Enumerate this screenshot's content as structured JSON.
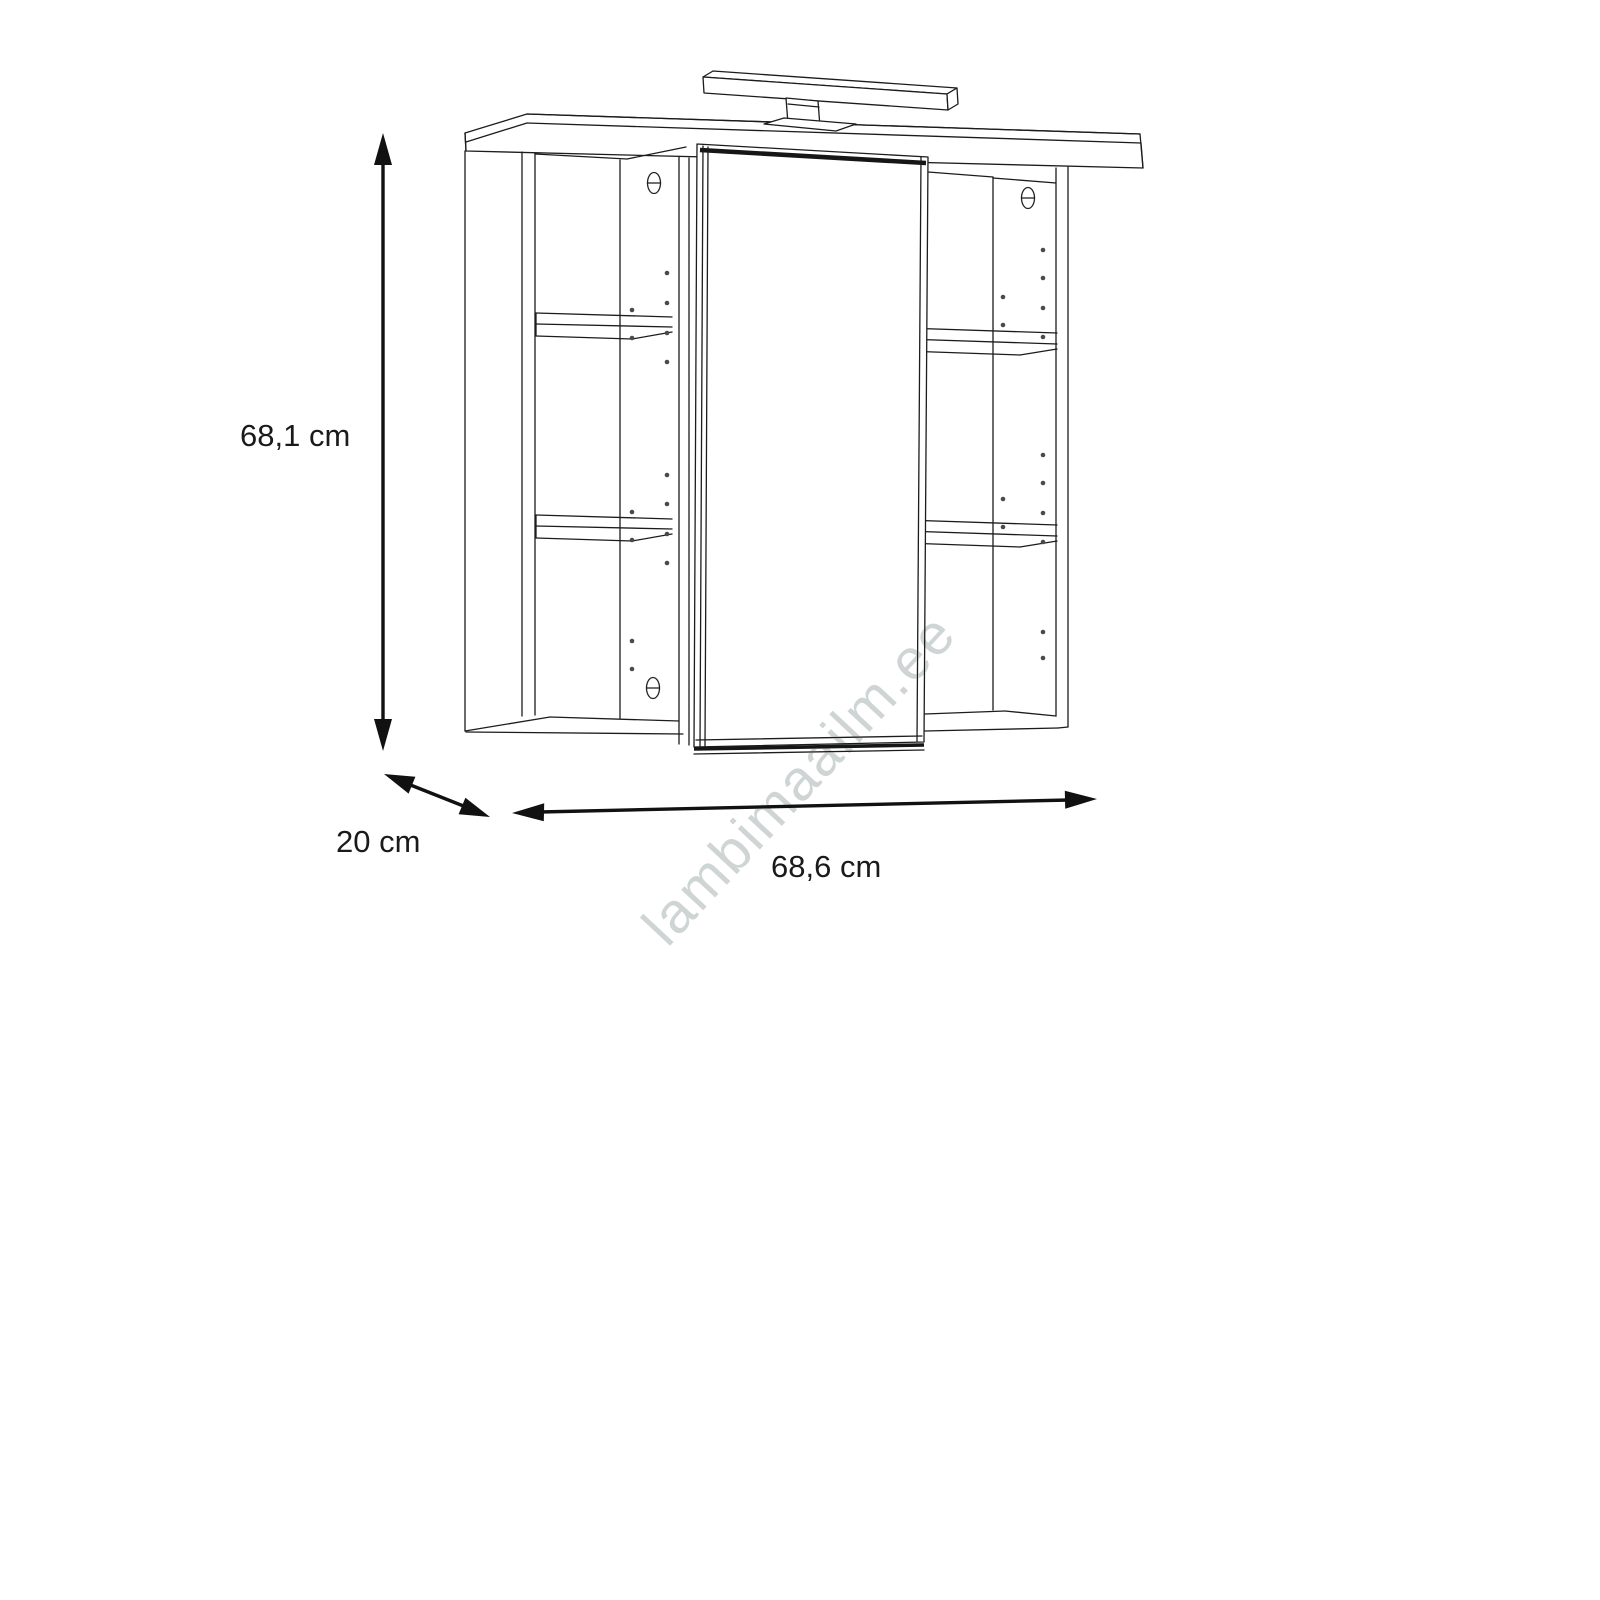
{
  "drawing": {
    "subject": "mirror-cabinet-technical-drawing",
    "dimensions": {
      "height": "68,1 cm",
      "depth": "20 cm",
      "width": "68,6 cm"
    },
    "watermark": "lambimaailm.ee"
  }
}
